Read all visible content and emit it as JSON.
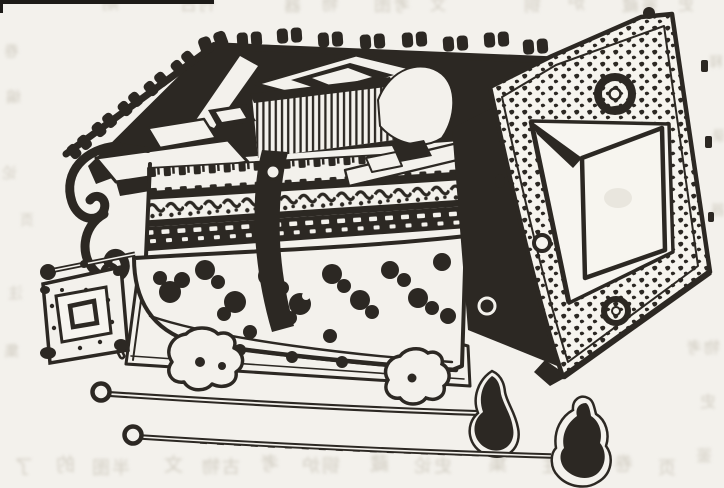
{
  "figure": {
    "kind": "Scanned book page with a woodcut-style ink illustration",
    "alt": "Ink line drawing of an ornate ancient bronze stove-like casket with crenellated lid knobs, decorated horizontal bands, a swing handle, a scroll bracket, an openwork cloud-pattern bowl on cloud feet over a slab base; a large square panel with punched decoration, ring handles and a square window leans against its right side; a small square tray with a raised boss sits at the left; two long thin rods with looped ends and gourd-shaped finials lie in front."
  },
  "palette": {
    "paper": "#f3f1ec",
    "paper_bright": "#f7f5f0",
    "ink": "#2c2823",
    "ink_soft": "#3a352e",
    "bleed": "#c9c4b8",
    "smudge": "#e7e4db"
  },
  "scan_artifacts": {
    "top_edge_strip": "black scanner strip along top-left edge",
    "bleed_note": "illegible mirrored text show-through from reverse side of the page"
  },
  "objects": [
    {
      "name": "stove-casket",
      "desc": "main vessel with knobbed rim, vent comb, ornament bands, openwork bowl and cloud feet"
    },
    {
      "name": "square-panel",
      "desc": "leaning square panel with dotted texture, two ring handles and square window"
    },
    {
      "name": "square-tray",
      "desc": "small square tray with raised square boss and corner feet"
    },
    {
      "name": "rod-a",
      "desc": "long rod, looped end left, gourd-shaped finial right"
    },
    {
      "name": "rod-b",
      "desc": "long rod, looped end left, larger gourd-shaped finial right"
    },
    {
      "name": "ball-pin",
      "desc": "short pin with round ball head beside the tray"
    }
  ],
  "bleed_text": {
    "note": "placeholder glyphs; original show-through is illegible",
    "marks": [
      {
        "t": "期",
        "x": 100,
        "y": -4,
        "s": 17
      },
      {
        "t": "刊古",
        "x": 178,
        "y": -3,
        "s": 17
      },
      {
        "t": "器",
        "x": 282,
        "y": -2,
        "s": 17
      },
      {
        "t": "物",
        "x": 320,
        "y": -3,
        "s": 16
      },
      {
        "t": "考图",
        "x": 372,
        "y": -2,
        "s": 17
      },
      {
        "t": "文",
        "x": 428,
        "y": -3,
        "s": 16
      },
      {
        "t": "铜",
        "x": 522,
        "y": -2,
        "s": 17
      },
      {
        "t": "炉",
        "x": 566,
        "y": -4,
        "s": 17
      },
      {
        "t": "鉴藏",
        "x": 620,
        "y": -2,
        "s": 17
      },
      {
        "t": "史",
        "x": 676,
        "y": -3,
        "s": 16
      },
      {
        "t": "卷",
        "x": 2,
        "y": 44,
        "s": 15
      },
      {
        "t": "编",
        "x": 4,
        "y": 90,
        "s": 15
      },
      {
        "t": "论",
        "x": 0,
        "y": 166,
        "s": 15
      },
      {
        "t": "页",
        "x": 18,
        "y": 214,
        "s": 14
      },
      {
        "t": "注",
        "x": 6,
        "y": 286,
        "s": 15
      },
      {
        "t": "集",
        "x": 2,
        "y": 344,
        "s": 15
      },
      {
        "t": "释",
        "x": 707,
        "y": 56,
        "s": 14
      },
      {
        "t": "录",
        "x": 710,
        "y": 130,
        "s": 14
      },
      {
        "t": "器",
        "x": 709,
        "y": 204,
        "s": 14
      },
      {
        "t": "物考",
        "x": 684,
        "y": 340,
        "s": 16
      },
      {
        "t": "史",
        "x": 698,
        "y": 394,
        "s": 16
      },
      {
        "t": "鉴",
        "x": 694,
        "y": 448,
        "s": 16
      },
      {
        "t": "了",
        "x": 12,
        "y": 458,
        "s": 19
      },
      {
        "t": "的",
        "x": 54,
        "y": 456,
        "s": 19
      },
      {
        "t": "半图",
        "x": 90,
        "y": 460,
        "s": 18
      },
      {
        "t": "文",
        "x": 162,
        "y": 456,
        "s": 19
      },
      {
        "t": "古物",
        "x": 200,
        "y": 459,
        "s": 18
      },
      {
        "t": "考",
        "x": 258,
        "y": 455,
        "s": 19
      },
      {
        "t": "铜炉",
        "x": 300,
        "y": 458,
        "s": 18
      },
      {
        "t": "藏",
        "x": 368,
        "y": 455,
        "s": 19
      },
      {
        "t": "史论",
        "x": 412,
        "y": 458,
        "s": 18
      },
      {
        "t": "集",
        "x": 486,
        "y": 455,
        "s": 19
      },
      {
        "t": "编注",
        "x": 540,
        "y": 458,
        "s": 18
      },
      {
        "t": "卷",
        "x": 612,
        "y": 455,
        "s": 19
      },
      {
        "t": "页",
        "x": 656,
        "y": 460,
        "s": 18
      }
    ]
  }
}
